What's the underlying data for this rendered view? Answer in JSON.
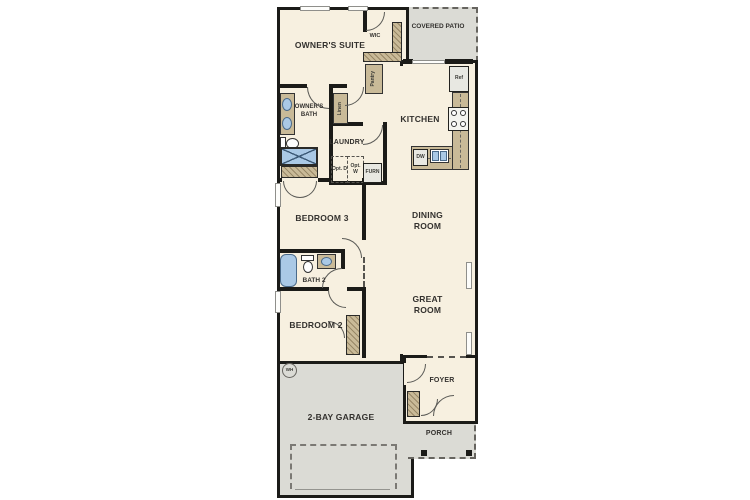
{
  "floorplan": {
    "rooms": {
      "owners_suite": "OWNER'S SUITE",
      "wic": "WIC",
      "covered_patio": "COVERED PATIO",
      "owners_bath": "OWNER'S BATH",
      "kitchen": "KITCHEN",
      "laundry": "LAUNDRY",
      "bedroom_3": "BEDROOM 3",
      "dining_room": "DINING ROOM",
      "bath_2": "BATH 2",
      "great_room": "GREAT ROOM",
      "bedroom_2": "BEDROOM 2",
      "foyer": "FOYER",
      "porch": "PORCH",
      "garage": "2-BAY GARAGE"
    },
    "fixtures": {
      "pantry": "Pantry",
      "linen": "Linen",
      "ref": "Ref",
      "dw": "DW",
      "furn": "FURN",
      "wh": "WH",
      "opt_dryer": "Opt. D",
      "opt_washer": "Opt. W"
    },
    "colors": {
      "floor": "#f7f0e0",
      "outdoor_floor": "#dbdbd5",
      "wall": "#1b1b18",
      "casework": "#c9ba98",
      "plumbing_fixture": "#aac9e6",
      "background": "#ffffff"
    }
  }
}
